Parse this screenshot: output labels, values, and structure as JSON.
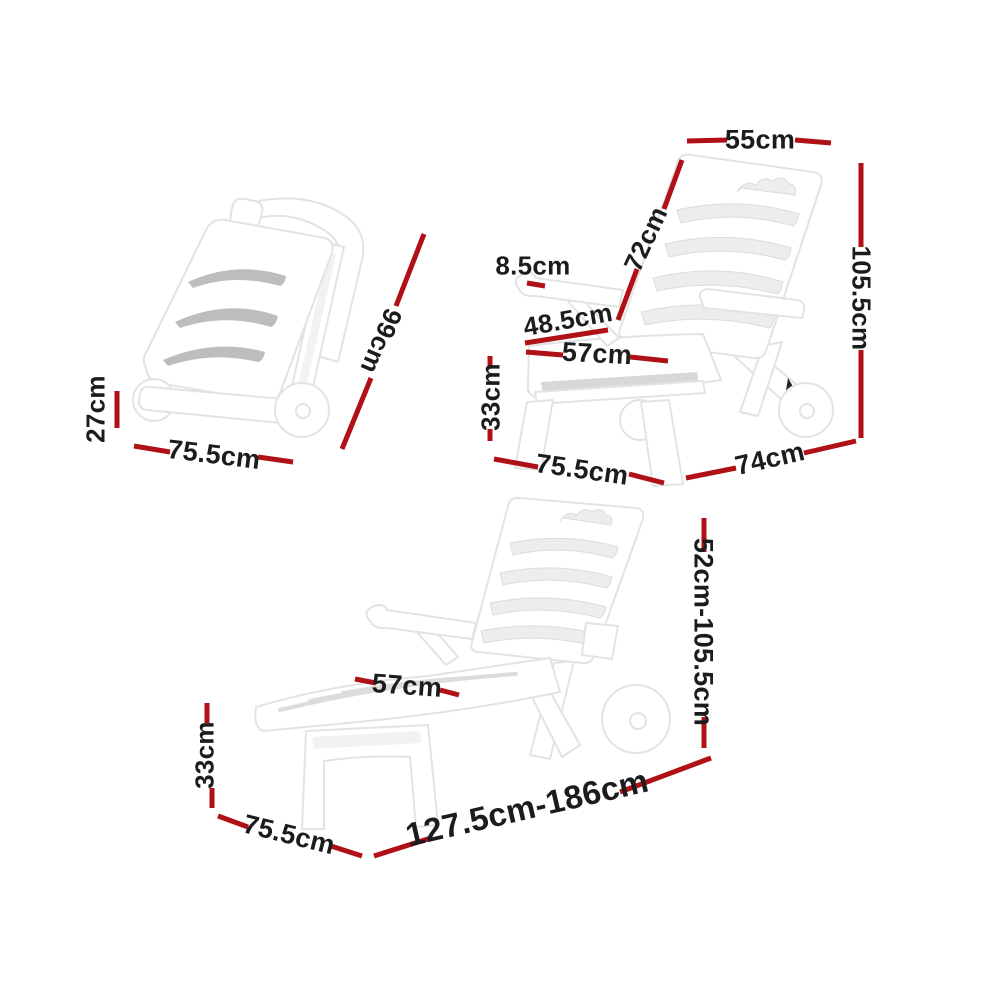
{
  "colors": {
    "dimension_line": "#b01117",
    "label_text": "#1c1c1c",
    "product_white": "#ffffff",
    "outline_gray": "#e3e3e3",
    "slot_gray": "#bdbdbd"
  },
  "annotations": {
    "folded": {
      "height": "27cm",
      "width": "75.5cm",
      "length": "99cm"
    },
    "chair": {
      "backrest_width": "55cm",
      "backrest_length": "72cm",
      "armrest_thickness": "8.5cm",
      "seat_depth": "48.5cm",
      "seat_width": "57cm",
      "seat_height": "33cm",
      "overall_height": "105.5cm",
      "overall_width": "75.5cm",
      "overall_depth": "74cm"
    },
    "lounger": {
      "seat_width": "57cm",
      "seat_height": "33cm",
      "adjustable_height": "52cm-105.5cm",
      "overall_width": "75.5cm",
      "extended_length": "127.5cm-186cm"
    }
  }
}
